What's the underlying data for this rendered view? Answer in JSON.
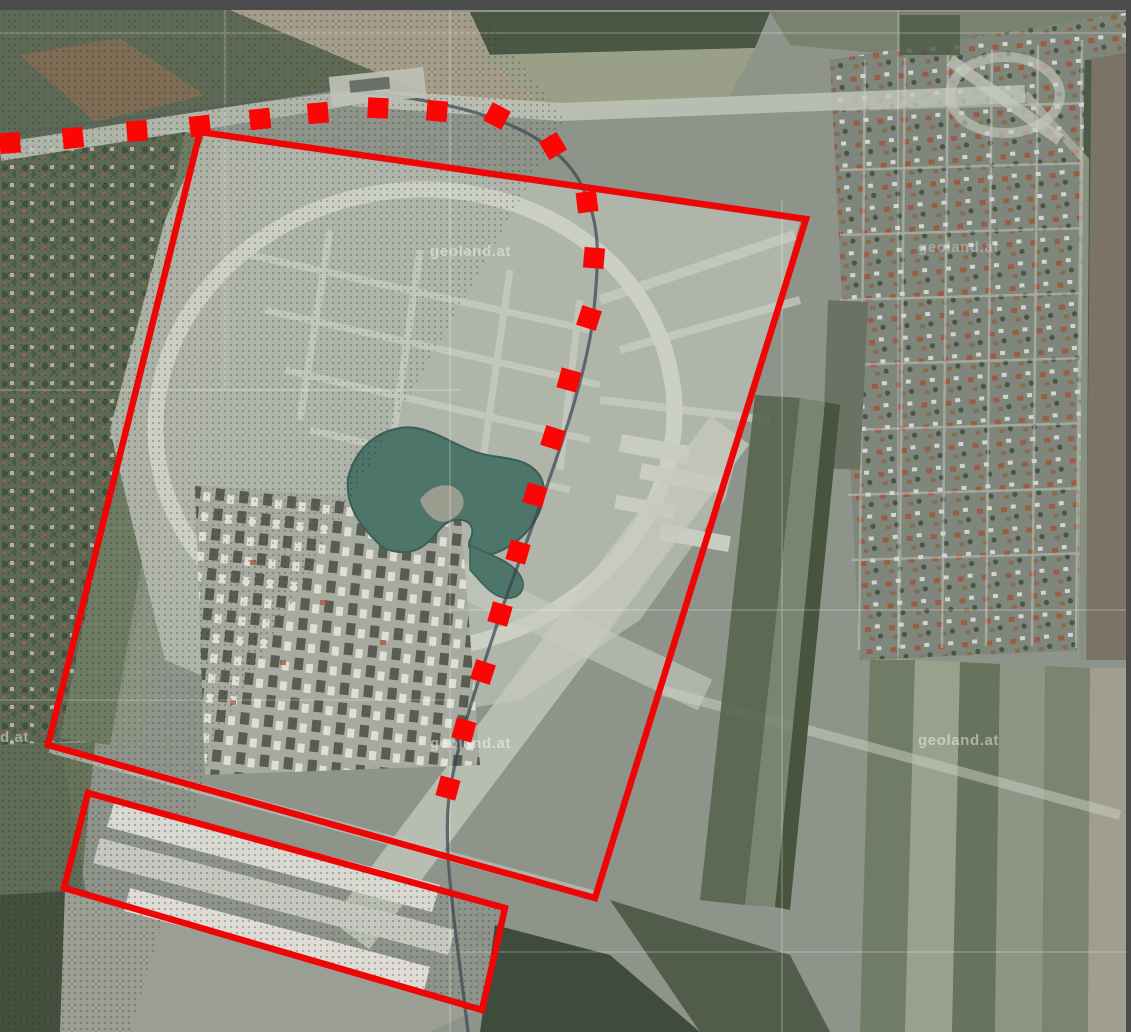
{
  "window": {
    "top_bar_color": "#4b4b4b",
    "right_edge_color": "#4b4b4b"
  },
  "map": {
    "description": "aerial-orthophoto-with-project-boundary-overlays",
    "provider_watermark": {
      "text": "geoland.at",
      "color": "#ffffff",
      "positions": [
        {
          "x": 430,
          "y": 256,
          "opacity": 0.45
        },
        {
          "x": 918,
          "y": 252,
          "opacity": 0.28
        },
        {
          "x": -52,
          "y": 742,
          "opacity": 0.45
        },
        {
          "x": 430,
          "y": 748,
          "opacity": 0.45
        },
        {
          "x": 918,
          "y": 745,
          "opacity": 0.45
        }
      ]
    },
    "annotations": {
      "color": "#ef0505",
      "dash_color": "#fb0505",
      "stroke_width": 6.5,
      "boundary_polygons": [
        {
          "name": "main-project-boundary",
          "points": [
            [
              200,
              132
            ],
            [
              806,
              219
            ],
            [
              595,
              898
            ],
            [
              48,
              745
            ]
          ]
        },
        {
          "name": "south-strip-boundary",
          "points": [
            [
              88,
              793
            ],
            [
              505,
              908
            ],
            [
              482,
              1010
            ],
            [
              64,
              888
            ]
          ]
        }
      ],
      "dashed_route": {
        "name": "dashed-route-line",
        "square_size": 20.5,
        "points": [
          [
            10,
            143
          ],
          [
            73,
            138
          ],
          [
            137,
            131
          ],
          [
            200,
            126
          ],
          [
            260,
            119
          ],
          [
            318,
            113
          ],
          [
            378,
            108
          ],
          [
            437,
            111
          ],
          [
            497,
            116
          ],
          [
            553,
            146
          ],
          [
            587,
            202
          ],
          [
            594,
            258
          ],
          [
            589,
            318
          ],
          [
            569,
            380
          ],
          [
            553,
            438
          ],
          [
            535,
            495
          ],
          [
            518,
            552
          ],
          [
            500,
            614
          ],
          [
            483,
            672
          ],
          [
            464,
            730
          ],
          [
            448,
            788
          ]
        ]
      }
    }
  }
}
